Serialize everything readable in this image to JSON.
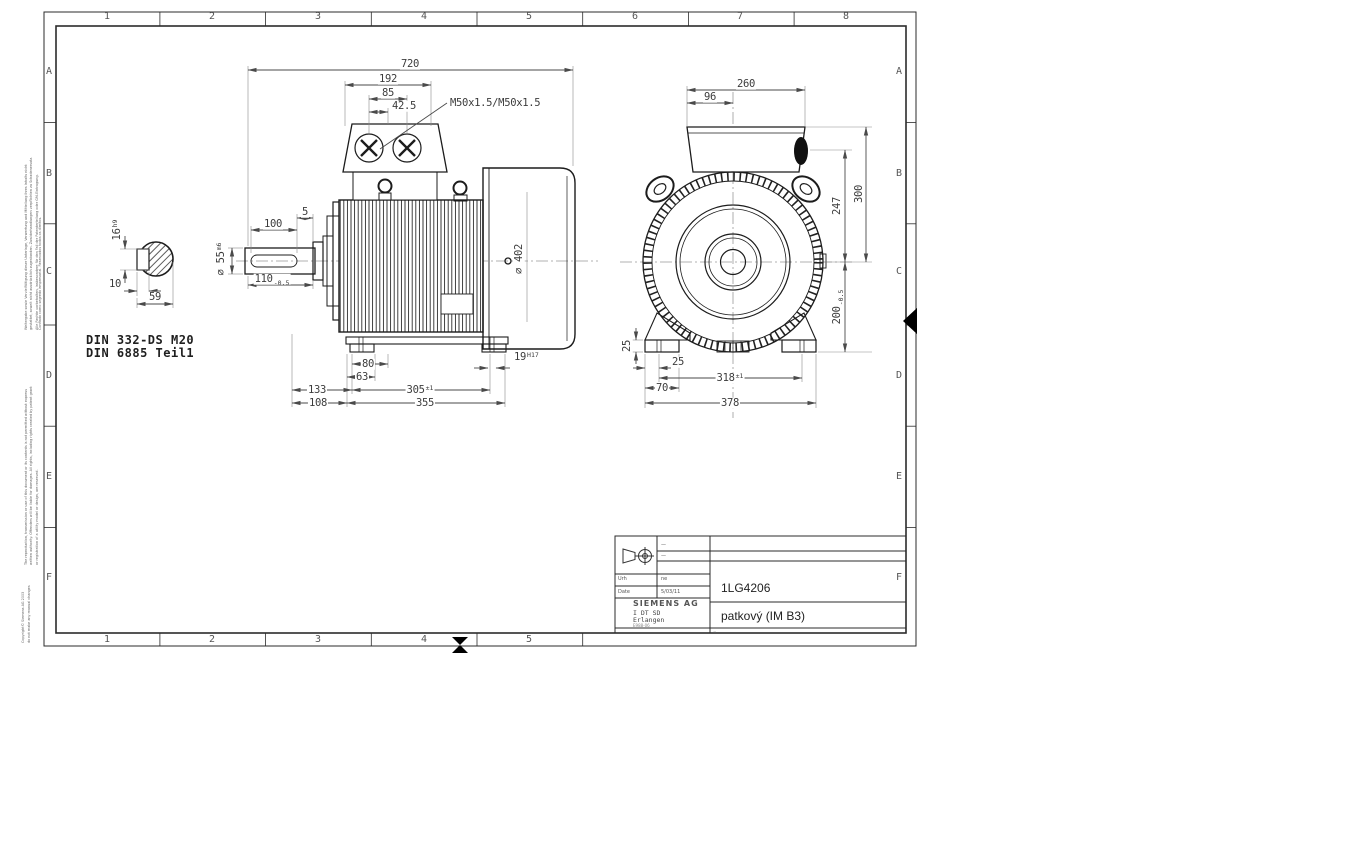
{
  "sheet": {
    "cols_top": [
      "1",
      "2",
      "3",
      "4",
      "5",
      "6",
      "7",
      "8"
    ],
    "cols_bottom": [
      "1",
      "2",
      "3",
      "4",
      "5"
    ],
    "rows_left": [
      "A",
      "B",
      "C",
      "D",
      "E",
      "F"
    ],
    "rows_right": [
      "A",
      "B",
      "C",
      "D",
      "E",
      "F"
    ]
  },
  "dims": {
    "side": {
      "d720": "720",
      "d192": "192",
      "d85": "85",
      "d42_5": "42.5",
      "thread": "M50x1.5/M50x1.5",
      "d5": "5",
      "d100": "100",
      "d55": "⌀ 55",
      "d55_tol": "m6",
      "d110": "110",
      "d110_tol": "-0.5",
      "d80": "80",
      "d63": "63",
      "d133": "133",
      "d108": "108",
      "d305": "305",
      "d305_tol": "±1",
      "d355": "355",
      "d19": "19",
      "d19_tol": "H17",
      "d402": "⌀ 402"
    },
    "front": {
      "d260": "260",
      "d96": "96",
      "d247": "247",
      "d300": "300",
      "d200": "200",
      "d200_tol": "-0.5",
      "d25v": "25",
      "d25h": "25",
      "d70": "70",
      "d318": "318",
      "d318_tol": "±1",
      "d378": "378"
    },
    "key": {
      "d16": "16",
      "d16_tol": "h9",
      "d10": "10",
      "d59": "59"
    }
  },
  "notes": {
    "din_line1": "DIN 332-DS M20",
    "din_line2": "DIN 6885 Teil1"
  },
  "titleblock": {
    "part_number": "1LG4206",
    "mounting": "patkový  (IM B3)",
    "company": "SIEMENS AG",
    "department": "I DT SD",
    "city": "Erlangen",
    "form_code": "E988-06",
    "field1_label": "Urh",
    "field1_value": "ne",
    "field2_label": "Date",
    "field2_value": "5/03/11",
    "rev_dash": "—",
    "corner_mark": "="
  },
  "margin": {
    "de": "Weitergabe sowie Vervielfältigung dieser Unterlage, Verwertung und Mitteilung ihres Inhalts nicht gestattet, soweit nicht ausdrücklich zugestanden. Zuwiderhandlungen verpflichten zu Schadenersatz. Alle Rechte vorbehalten, insbesondere für den Fall der Patenterteilung oder GM-Eintragung.",
    "pt": "Confiado como segredo empresarial. Reservados todos os direitos.",
    "en": "The reproduction, transmission or use of this document or its contents is not permitted without express written authority. Offenders will be liable for damages. All rights, including rights created by patent grant or registration of a utility model or design, are reserved.",
    "copyright": "Copyright© Siemens AG 2003",
    "note": "do not make any manual changes"
  }
}
